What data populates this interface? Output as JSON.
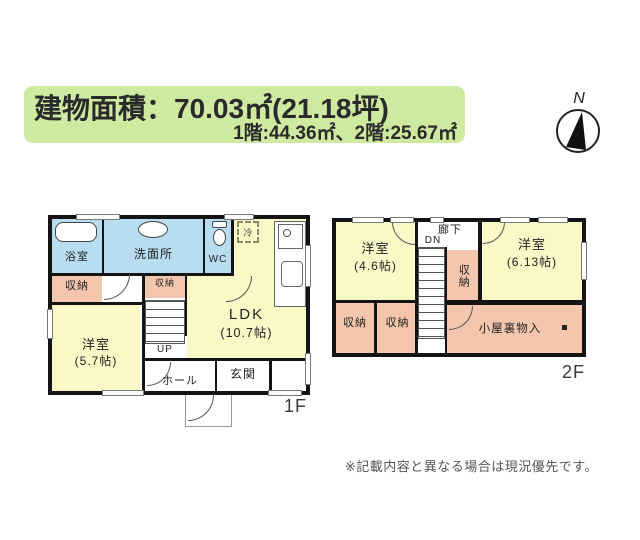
{
  "header": {
    "line1": "建物面積：70.03㎡(21.18坪)",
    "line2": "1階:44.36㎡、2階:25.67㎡"
  },
  "compass": {
    "north_label": "N"
  },
  "floor1": {
    "floor_label": "1F",
    "bath": "浴室",
    "washroom": "洗面所",
    "wc": "WC",
    "closet_left": "収納",
    "closet_center": "収納",
    "bedroom": "洋室",
    "bedroom_size": "(5.7帖)",
    "ldk": "LDK",
    "ldk_size": "(10.7帖)",
    "stairs_label": "UP",
    "hall": "ホール",
    "entrance": "玄関",
    "fridge": "冷"
  },
  "floor2": {
    "floor_label": "2F",
    "bedroom_left": "洋室",
    "bedroom_left_size": "(4.6帖)",
    "corridor": "廊下",
    "stairs_label": "DN",
    "closet_a": "収納",
    "closet_b": "収納",
    "closet_mid": "収納",
    "bedroom_right": "洋室",
    "bedroom_right_size": "(6.13帖)",
    "attic": "小屋裏物入"
  },
  "footer": {
    "note": "※記載内容と異なる場合は現況優先です。"
  },
  "colors": {
    "header_bg": "#cdeaa0",
    "room_yellow": "#fbf8c7",
    "room_blue": "#b8dcf0",
    "room_pink": "#f4c6ad",
    "wall": "#141414"
  }
}
